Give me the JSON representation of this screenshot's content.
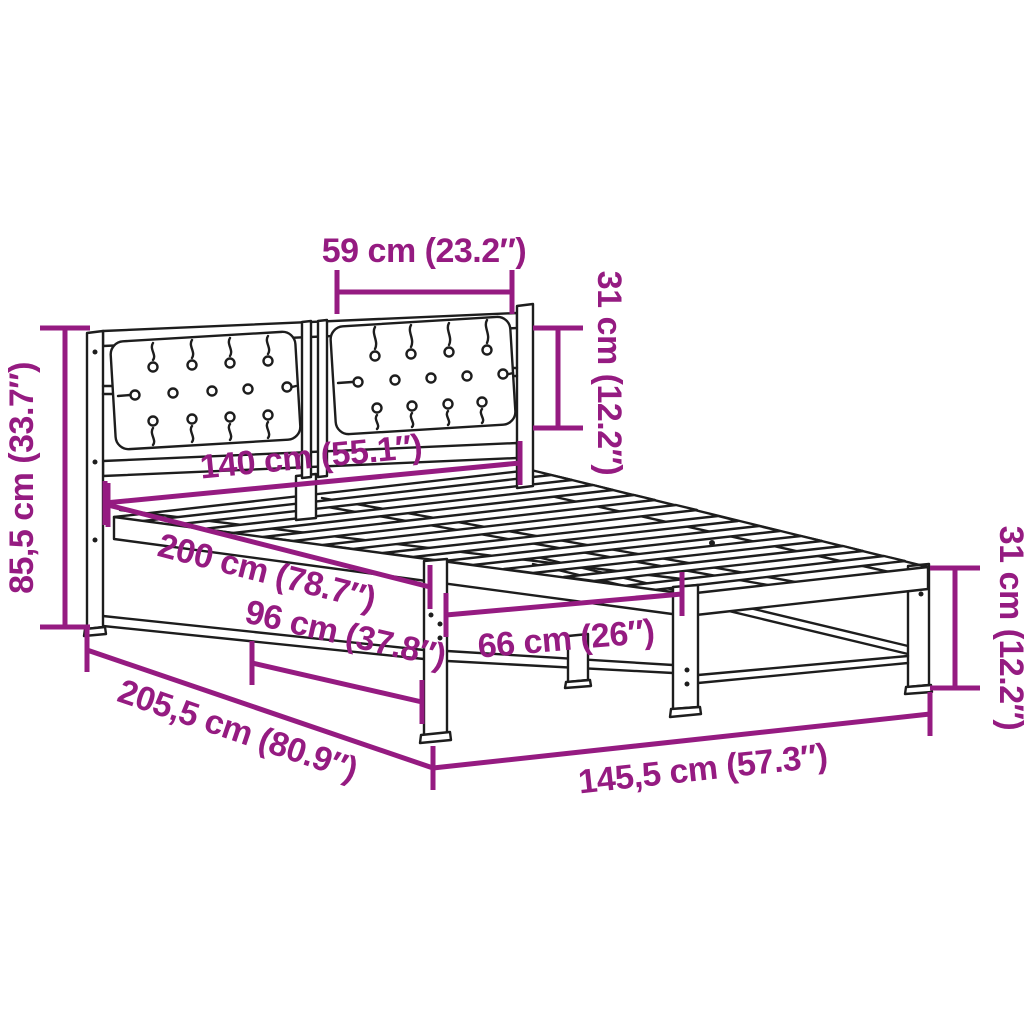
{
  "image_type": "product-dimension-diagram",
  "product": "bed-frame-with-tufted-headboard-and-slats",
  "colors": {
    "annotation": "#951B81",
    "line_art": "#1D1D1D",
    "background": "#FFFFFF"
  },
  "dimensions": {
    "cushion_width": "59 cm (23.2″)",
    "cushion_height": "31 cm (12.2″)",
    "headboard_height": "85,5 cm (33.7″)",
    "bed_width": "140 cm (55.1″)",
    "bed_length": "200 cm (78.7″)",
    "clearance_head": "96 cm (37.8″)",
    "clearance_foot": "66 cm (26″)",
    "total_length": "205,5 cm (80.9″)",
    "total_width": "145,5 cm (57.3″)",
    "leg_height": "31 cm (12.2″)"
  }
}
